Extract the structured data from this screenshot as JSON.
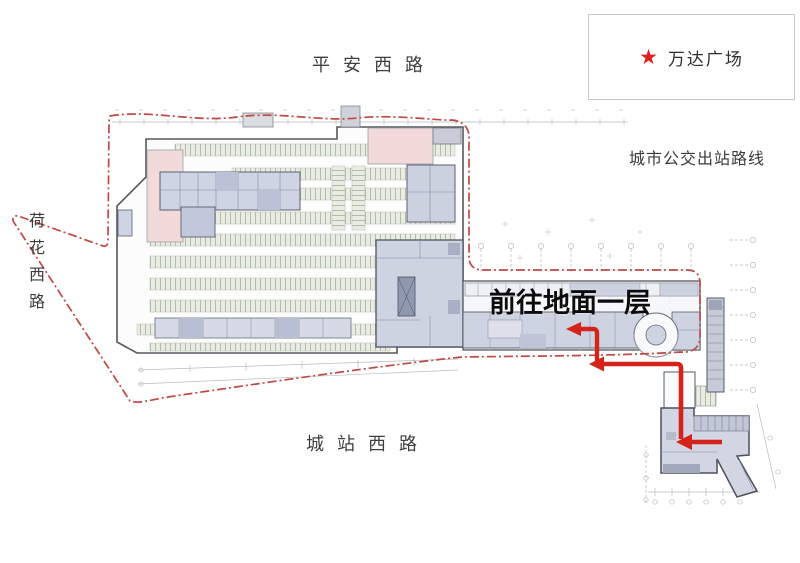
{
  "legend": {
    "label": "万达广场",
    "marker_icon": "star-icon",
    "marker_color": "#e32020"
  },
  "roads": {
    "top": "平安西路",
    "left": "荷花西路",
    "bottom": "城站西路"
  },
  "route": {
    "title": "城市公交出站路线",
    "destination_label": "前往地面一层",
    "arrow_color": "#d42318",
    "site_boundary_color": "#c04845"
  },
  "plan_colors": {
    "parking_stall_fill": "#e9ece3",
    "room_lavender": "#ced3e2",
    "room_pink": "#f2dada",
    "outline_gray": "#54585f",
    "grid_gray": "#b6bac0"
  }
}
